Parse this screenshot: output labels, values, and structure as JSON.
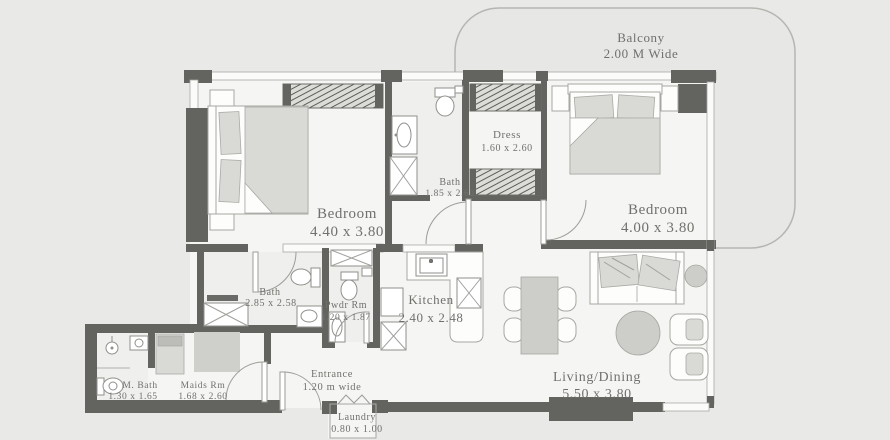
{
  "plan": {
    "balcony": {
      "name": "Balcony",
      "dims": "2.00 M Wide"
    },
    "rooms": {
      "bedroom_left": {
        "name": "Bedroom",
        "dims": "4.40 x 3.80"
      },
      "bedroom_right": {
        "name": "Bedroom",
        "dims": "4.00 x 3.80"
      },
      "dress": {
        "name": "Dress",
        "dims": "1.60 x 2.60"
      },
      "bath_top": {
        "name": "Bath",
        "dims": "1.85 x 2.60"
      },
      "bath_master": {
        "name": "Bath",
        "dims": "2.85 x 2.58"
      },
      "powder": {
        "name": "Pwdr Rm",
        "dims": "1.20 x 1.87"
      },
      "kitchen": {
        "name": "Kitchen",
        "dims": "2.40 x 2.48"
      },
      "living": {
        "name": "Living/Dining",
        "dims": "5.50 x 3.80"
      },
      "maid_bath": {
        "name": "M. Bath",
        "dims": "1.30 x 1.65"
      },
      "maids": {
        "name": "Maids Rm",
        "dims": "1.68 x 2.60"
      },
      "entrance": {
        "name": "Entrance",
        "dims": "1.20 m wide"
      },
      "laundry": {
        "name": "Laundry",
        "dims": "0.80 x 1.00"
      }
    },
    "colors": {
      "wall": "#636360",
      "floor": "#f5f5f3",
      "background": "#e9e9e7",
      "furniture_gray": "#d9d9d6",
      "label_text": "#70706c"
    }
  }
}
